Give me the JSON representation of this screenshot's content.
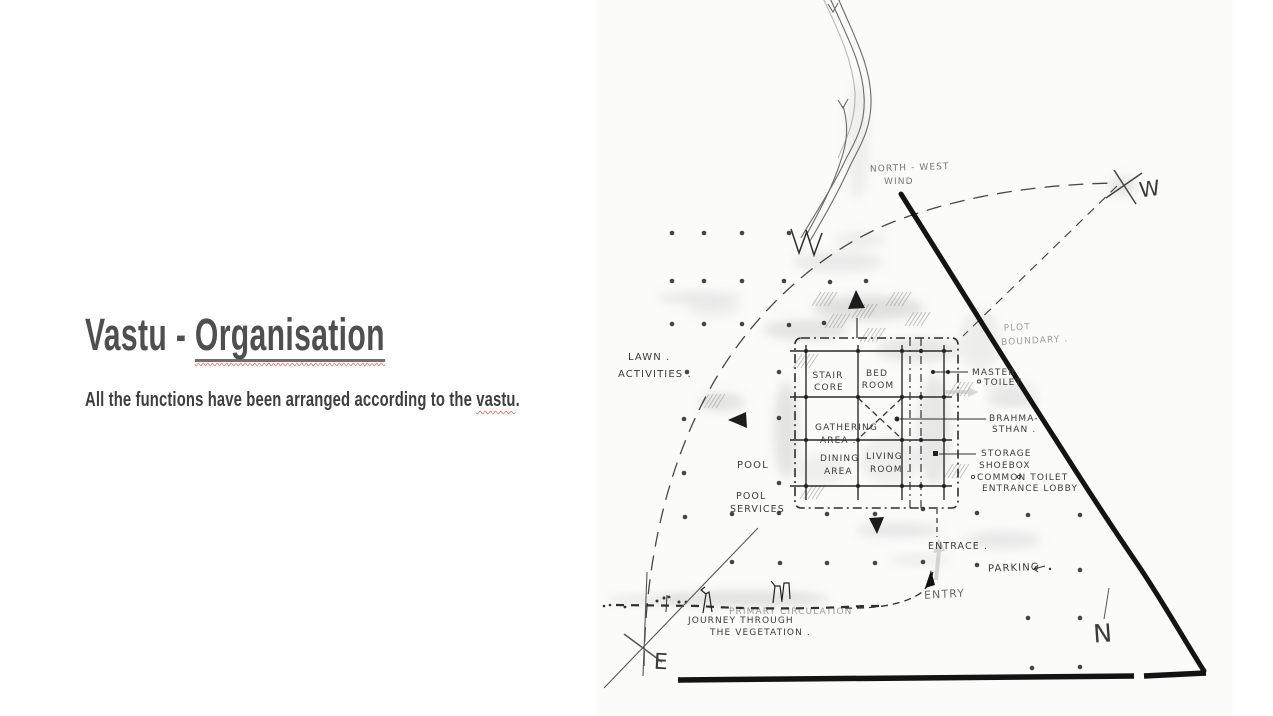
{
  "slide": {
    "title": {
      "plain": "Vastu - ",
      "underlined": "Organisation"
    },
    "subtitle": {
      "before": "All the functions have been arranged according to the ",
      "flagged": "vastu",
      "after": "."
    },
    "colors": {
      "title_text": "#4f4f4f",
      "spellcheck_squiggle": "#e2796e"
    }
  },
  "sketch": {
    "compass": {
      "west": "W",
      "east": "E",
      "north": "N"
    },
    "site_labels": {
      "north_west_wind": [
        "NORTH - WEST",
        "WIND"
      ],
      "plot_boundary": [
        "PLOT",
        "BOUNDARY ."
      ],
      "lawn_activities": [
        "LAWN .",
        "ACTIVITIES ."
      ],
      "pool": "POOL",
      "pool_services": [
        "POOL",
        "SERVICES"
      ],
      "entrance": "ENTRACE .",
      "entry": "ENTRY",
      "parking": "PARKING",
      "primary_circulation": "PRIMARY  CIRCULATION",
      "journey_through_vegetation": [
        "JOURNEY   THROUGH",
        "THE   VEGETATION ."
      ]
    },
    "room_labels": {
      "stair_core": [
        "STAIR",
        "CORE"
      ],
      "bed_room": [
        "BED",
        "ROOM"
      ],
      "master_toilet": [
        "MASTER",
        "TOILET"
      ],
      "gathering_area": [
        "GATHERING",
        "AREA ."
      ],
      "brahmasthan": [
        "BRAHMA-",
        "STHAN ."
      ],
      "dining_area": [
        "DINING",
        "AREA ."
      ],
      "living_room": [
        "LIVING",
        "ROOM ."
      ],
      "storage_block": [
        "STORAGE",
        "SHOEBOX",
        "COMMON   TOILET",
        "ENTRANCE   LOBBY"
      ]
    }
  }
}
